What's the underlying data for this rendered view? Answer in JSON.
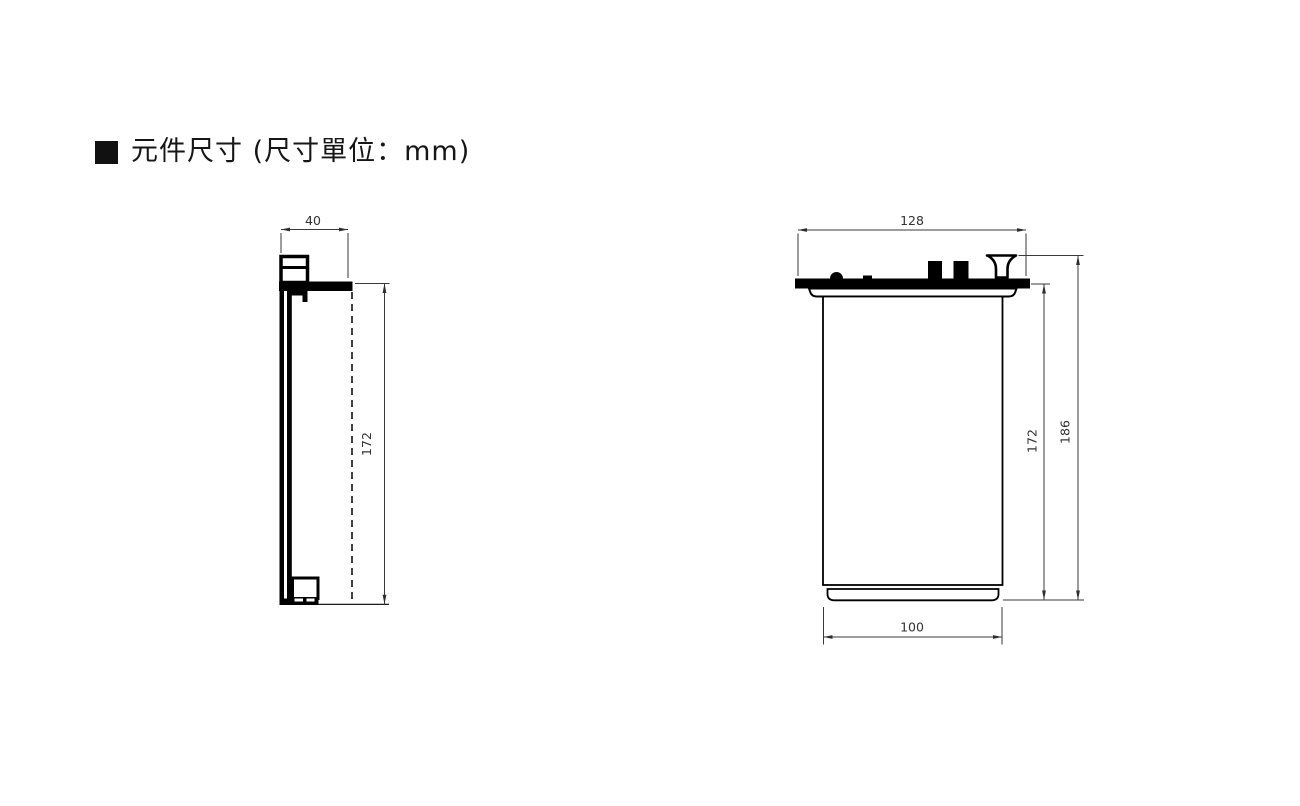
{
  "title": {
    "marker_icon": "black-square",
    "text": "元件尺寸 (尺寸單位：mm)"
  },
  "drawing": {
    "type": "technical-dimension-drawing",
    "unit": "mm",
    "side_view": {
      "dims": {
        "top_width": "40",
        "height": "172"
      }
    },
    "front_view": {
      "dims": {
        "top_width": "128",
        "body_height": "172",
        "total_height": "186",
        "bottom_width": "100"
      }
    }
  },
  "colors": {
    "background": "#ffffff",
    "part_outline": "#000000",
    "dimension_line": "#3a3a3a",
    "title_text": "#161616"
  }
}
